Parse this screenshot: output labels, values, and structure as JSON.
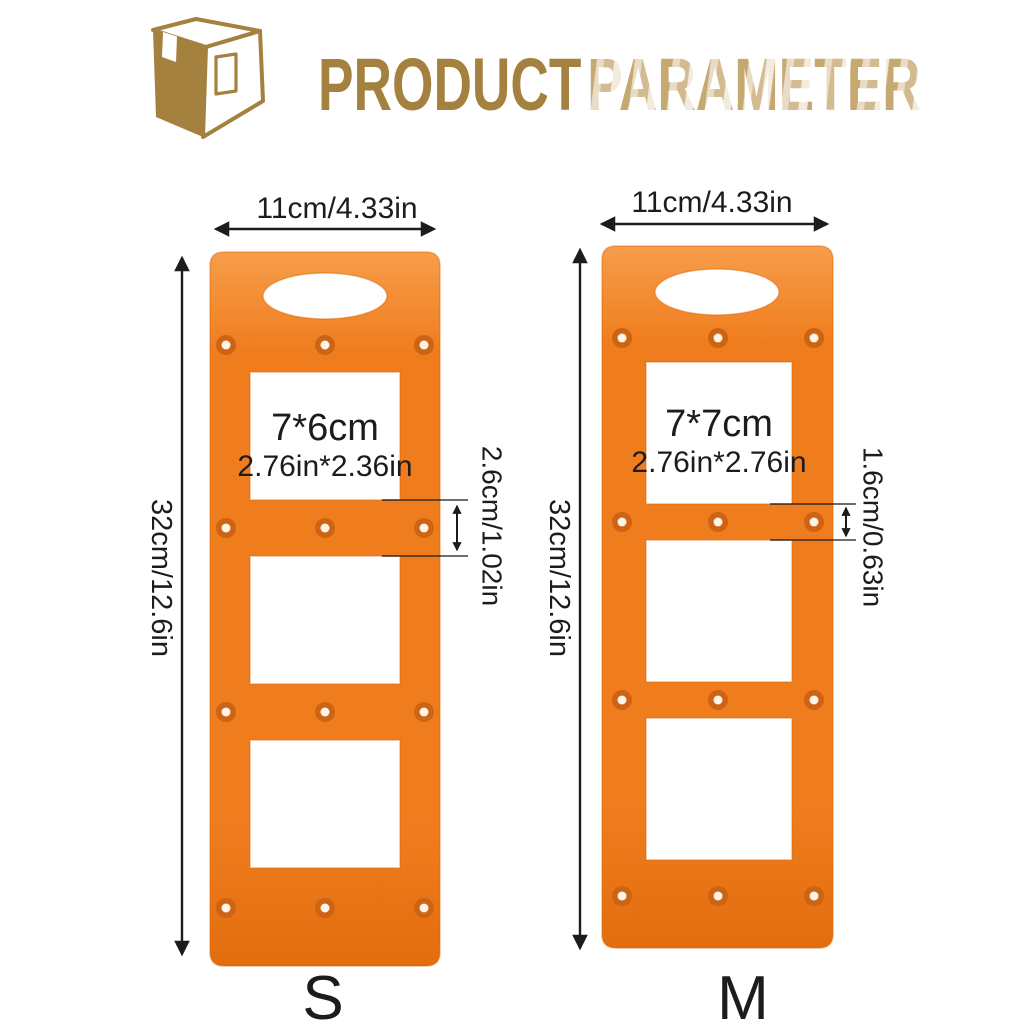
{
  "header": {
    "logo_icon": "package-box-icon",
    "title_word_1": "PRODUCT",
    "title_word_2": "PARAMETER",
    "brand_gold": "#a5813f",
    "brand_gold_faded": "#c3a469"
  },
  "diagram": {
    "plate_color_top": "#f79d4a",
    "plate_color": "#ef7d1e",
    "plate_color_bottom": "#e26d0e",
    "hole_ring": "#cd6414",
    "hole_center": "#fdf3e6",
    "line_color": "#1c1c1c",
    "templates": [
      {
        "size_label": "S",
        "width_label": "11cm/4.33in",
        "height_label": "32cm/12.6in",
        "slot_cm": "7*6cm",
        "slot_in": "2.76in*2.36in",
        "gap_label": "2.6cm/1.02in"
      },
      {
        "size_label": "M",
        "width_label": "11cm/4.33in",
        "height_label": "32cm/12.6in",
        "slot_cm": "7*7cm",
        "slot_in": "2.76in*2.76in",
        "gap_label": "1.6cm/0.63in"
      }
    ]
  }
}
